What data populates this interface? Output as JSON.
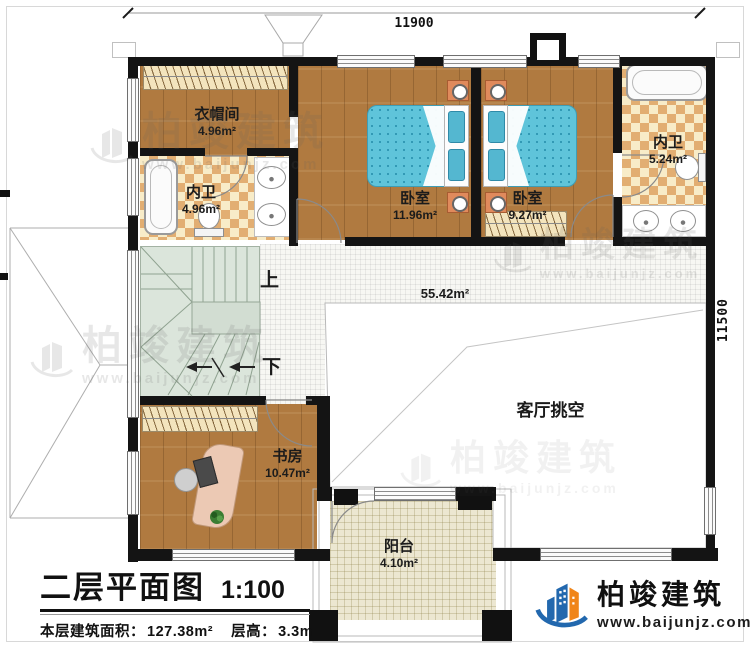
{
  "sheet": {
    "title": "二层平面图",
    "scale_label": "1:100",
    "area_label": "本层建筑面积：",
    "area_value": "127.38m²",
    "height_label": "层高：",
    "height_value": "3.3m"
  },
  "dimensions": {
    "top": "11900",
    "right": "11500"
  },
  "rooms": [
    {
      "name": "衣帽间",
      "area": "4.96m²"
    },
    {
      "name": "内卫",
      "area": "4.96m²"
    },
    {
      "name": "卧室",
      "area": "11.96m²"
    },
    {
      "name": "卧室",
      "area": "9.27m²"
    },
    {
      "name": "内卫",
      "area": "5.24m²"
    },
    {
      "name": "书房",
      "area": "10.47m²"
    },
    {
      "name": "阳台",
      "area": "4.10m²"
    }
  ],
  "hall": {
    "name": "客厅挑空",
    "area": "55.42m²"
  },
  "stairs": {
    "up": "上",
    "down": "下"
  },
  "brand": {
    "name": "柏竣建筑",
    "url": "www.baijunjz.com"
  },
  "colors": {
    "wall": "#141414",
    "wood": "#b07a40",
    "tile_light": "#f8ecc8",
    "tile_dark": "#e2ae72",
    "bed": "#5fc4da",
    "stair": "#dbe5db",
    "balcony_tile": "#ece7d1",
    "brand_blue": "#2268ae",
    "brand_orange": "#f08519"
  }
}
